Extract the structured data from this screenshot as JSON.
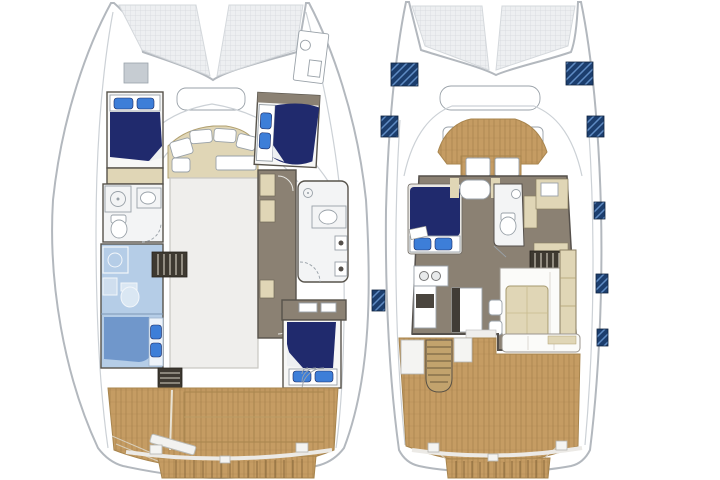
{
  "page": {
    "background": "#ffffff"
  },
  "palette": {
    "white": "#ffffff",
    "hull-line": "#b3b8be",
    "deck-line": "#ccd1d6",
    "wall": "#57534b",
    "mesh-bg": "#edeff1",
    "mesh-line": "#d4d8dc",
    "wood": "#c59c63",
    "wood-grain": "#8f6c3b",
    "wood-edge": "#a8854e",
    "bed-navy": "#202a6d",
    "pillow-blue": "#3d7ed8",
    "highlight-room": "#b5cde7",
    "highlight-bed": "#7097cb",
    "beige": "#e0d6b6",
    "beige-line": "#b1a070",
    "taupe": "#8b8173",
    "hatch-navy": "#1c3e6e",
    "hatch-sheen": "#6f9fd8",
    "fixture-line": "#99a1a8",
    "steps-dark": "#3e3931",
    "steps-tread": "#d7d1c3",
    "void": "#efeeec",
    "room": "#f7f7f6",
    "bath": "#f3f4f5",
    "skylight": "#c6ccd2"
  },
  "plans": {
    "lower_deck": {
      "name": "lower-deck-plan",
      "features": [
        "trampoline",
        "port-forward-cabin",
        "port-head",
        "port-highlighted-cabin",
        "forward-dinette",
        "salon-void",
        "companionway-steps",
        "starboard-forward-cabin",
        "starboard-corridor",
        "starboard-head",
        "starboard-aft-cabin",
        "aft-deck",
        "swim-platform"
      ]
    },
    "main_deck": {
      "name": "main-deck-plan",
      "features": [
        "trampoline",
        "foredeck-hatches",
        "forward-cockpit",
        "owner-berth",
        "day-head",
        "dinette-table",
        "galley",
        "stairs-down",
        "salon-sofa",
        "coffee-table",
        "sideboard",
        "aft-cockpit",
        "aft-stairs",
        "aft-sofa",
        "swim-platform",
        "side-deck-hatches"
      ]
    }
  }
}
